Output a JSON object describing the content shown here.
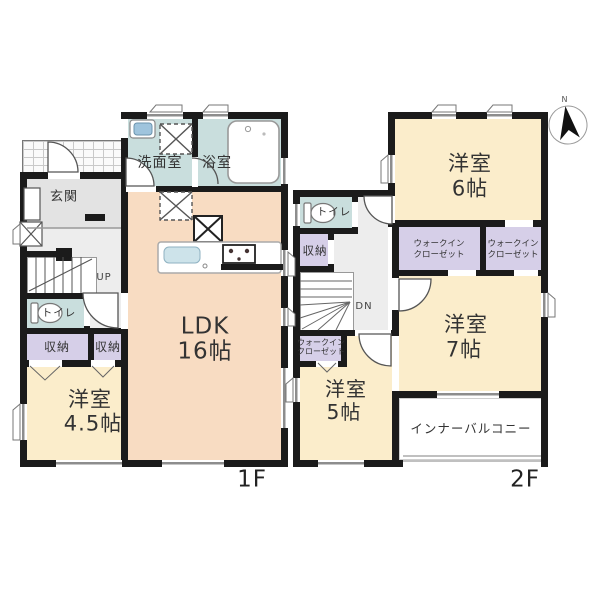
{
  "floor1": {
    "floor_label": "1F",
    "entrance": "玄関",
    "washroom": "洗面室",
    "bathroom": "浴室",
    "ldk_name": "LDK",
    "ldk_size": "16帖",
    "stairs": "UP",
    "toilet": "トイレ",
    "storage_left": "収納",
    "storage_right": "収納",
    "bedroom_name": "洋室",
    "bedroom_size": "4.5帖"
  },
  "floor2": {
    "floor_label": "2F",
    "bedroom6_name": "洋室",
    "bedroom6_size": "6帖",
    "toilet": "トイレ",
    "storage": "収納",
    "wic_a_line1": "ウォークイン",
    "wic_a_line2": "クローゼット",
    "wic_b_line1": "ウォークイン",
    "wic_b_line2": "クローゼット",
    "wic_c_line1": "ウォークイン",
    "wic_c_line2": "クローゼット",
    "stairs": "DN",
    "bedroom7_name": "洋室",
    "bedroom7_size": "7帖",
    "bedroom5_name": "洋室",
    "bedroom5_size": "5帖",
    "balcony": "インナーバルコニー"
  },
  "compass": {
    "north_label": "N"
  },
  "colors": {
    "wall": "#1b1b1b",
    "ldk": "#f8dcc2",
    "bedroom": "#fbedcb",
    "wet_area": "#c9dedd",
    "storage": "#d6cfe8",
    "hall": "#ededed"
  }
}
